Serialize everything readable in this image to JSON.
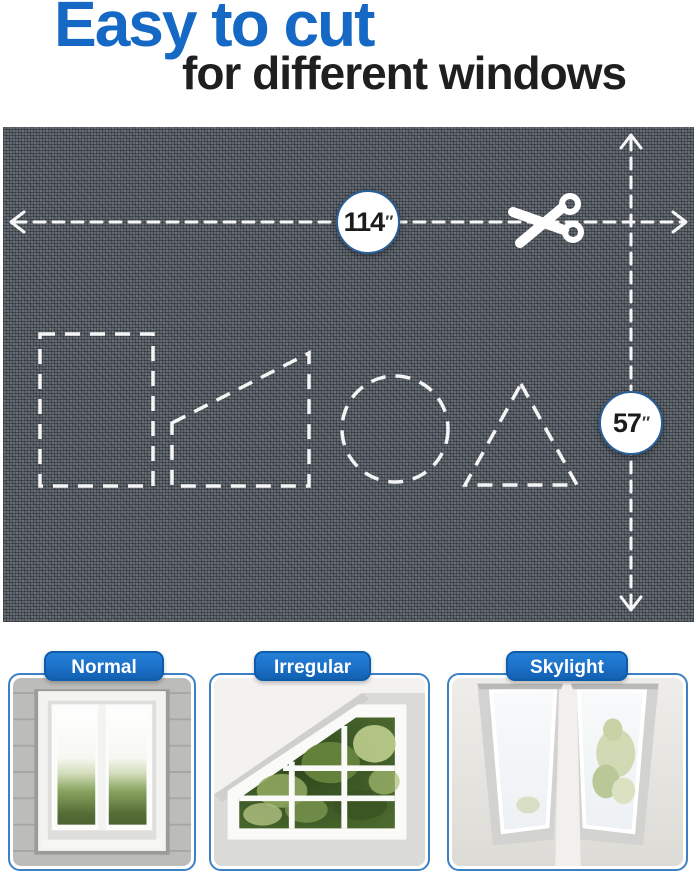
{
  "header": {
    "title": "Easy to cut",
    "subtitle": "for different windows"
  },
  "fabric": {
    "width_label": {
      "value": "114",
      "unit": "″"
    },
    "height_label": {
      "value": "57",
      "unit": "″"
    },
    "icons": {
      "scissors_icon": "✂"
    },
    "cut_shapes": [
      "rectangle",
      "trapezoid",
      "circle",
      "triangle"
    ]
  },
  "categories": [
    {
      "label": "Normal"
    },
    {
      "label": "Irregular"
    },
    {
      "label": "Skylight"
    }
  ],
  "colors": {
    "accent_blue": "#1568c4",
    "badge_blue": "#1c70c8",
    "badge_blue_dark": "#0f5cab",
    "card_border": "#3e80c4",
    "mesh_gray": "#5f666e",
    "dash_white": "#f7f7f7",
    "text_dark": "#1f1f21"
  }
}
